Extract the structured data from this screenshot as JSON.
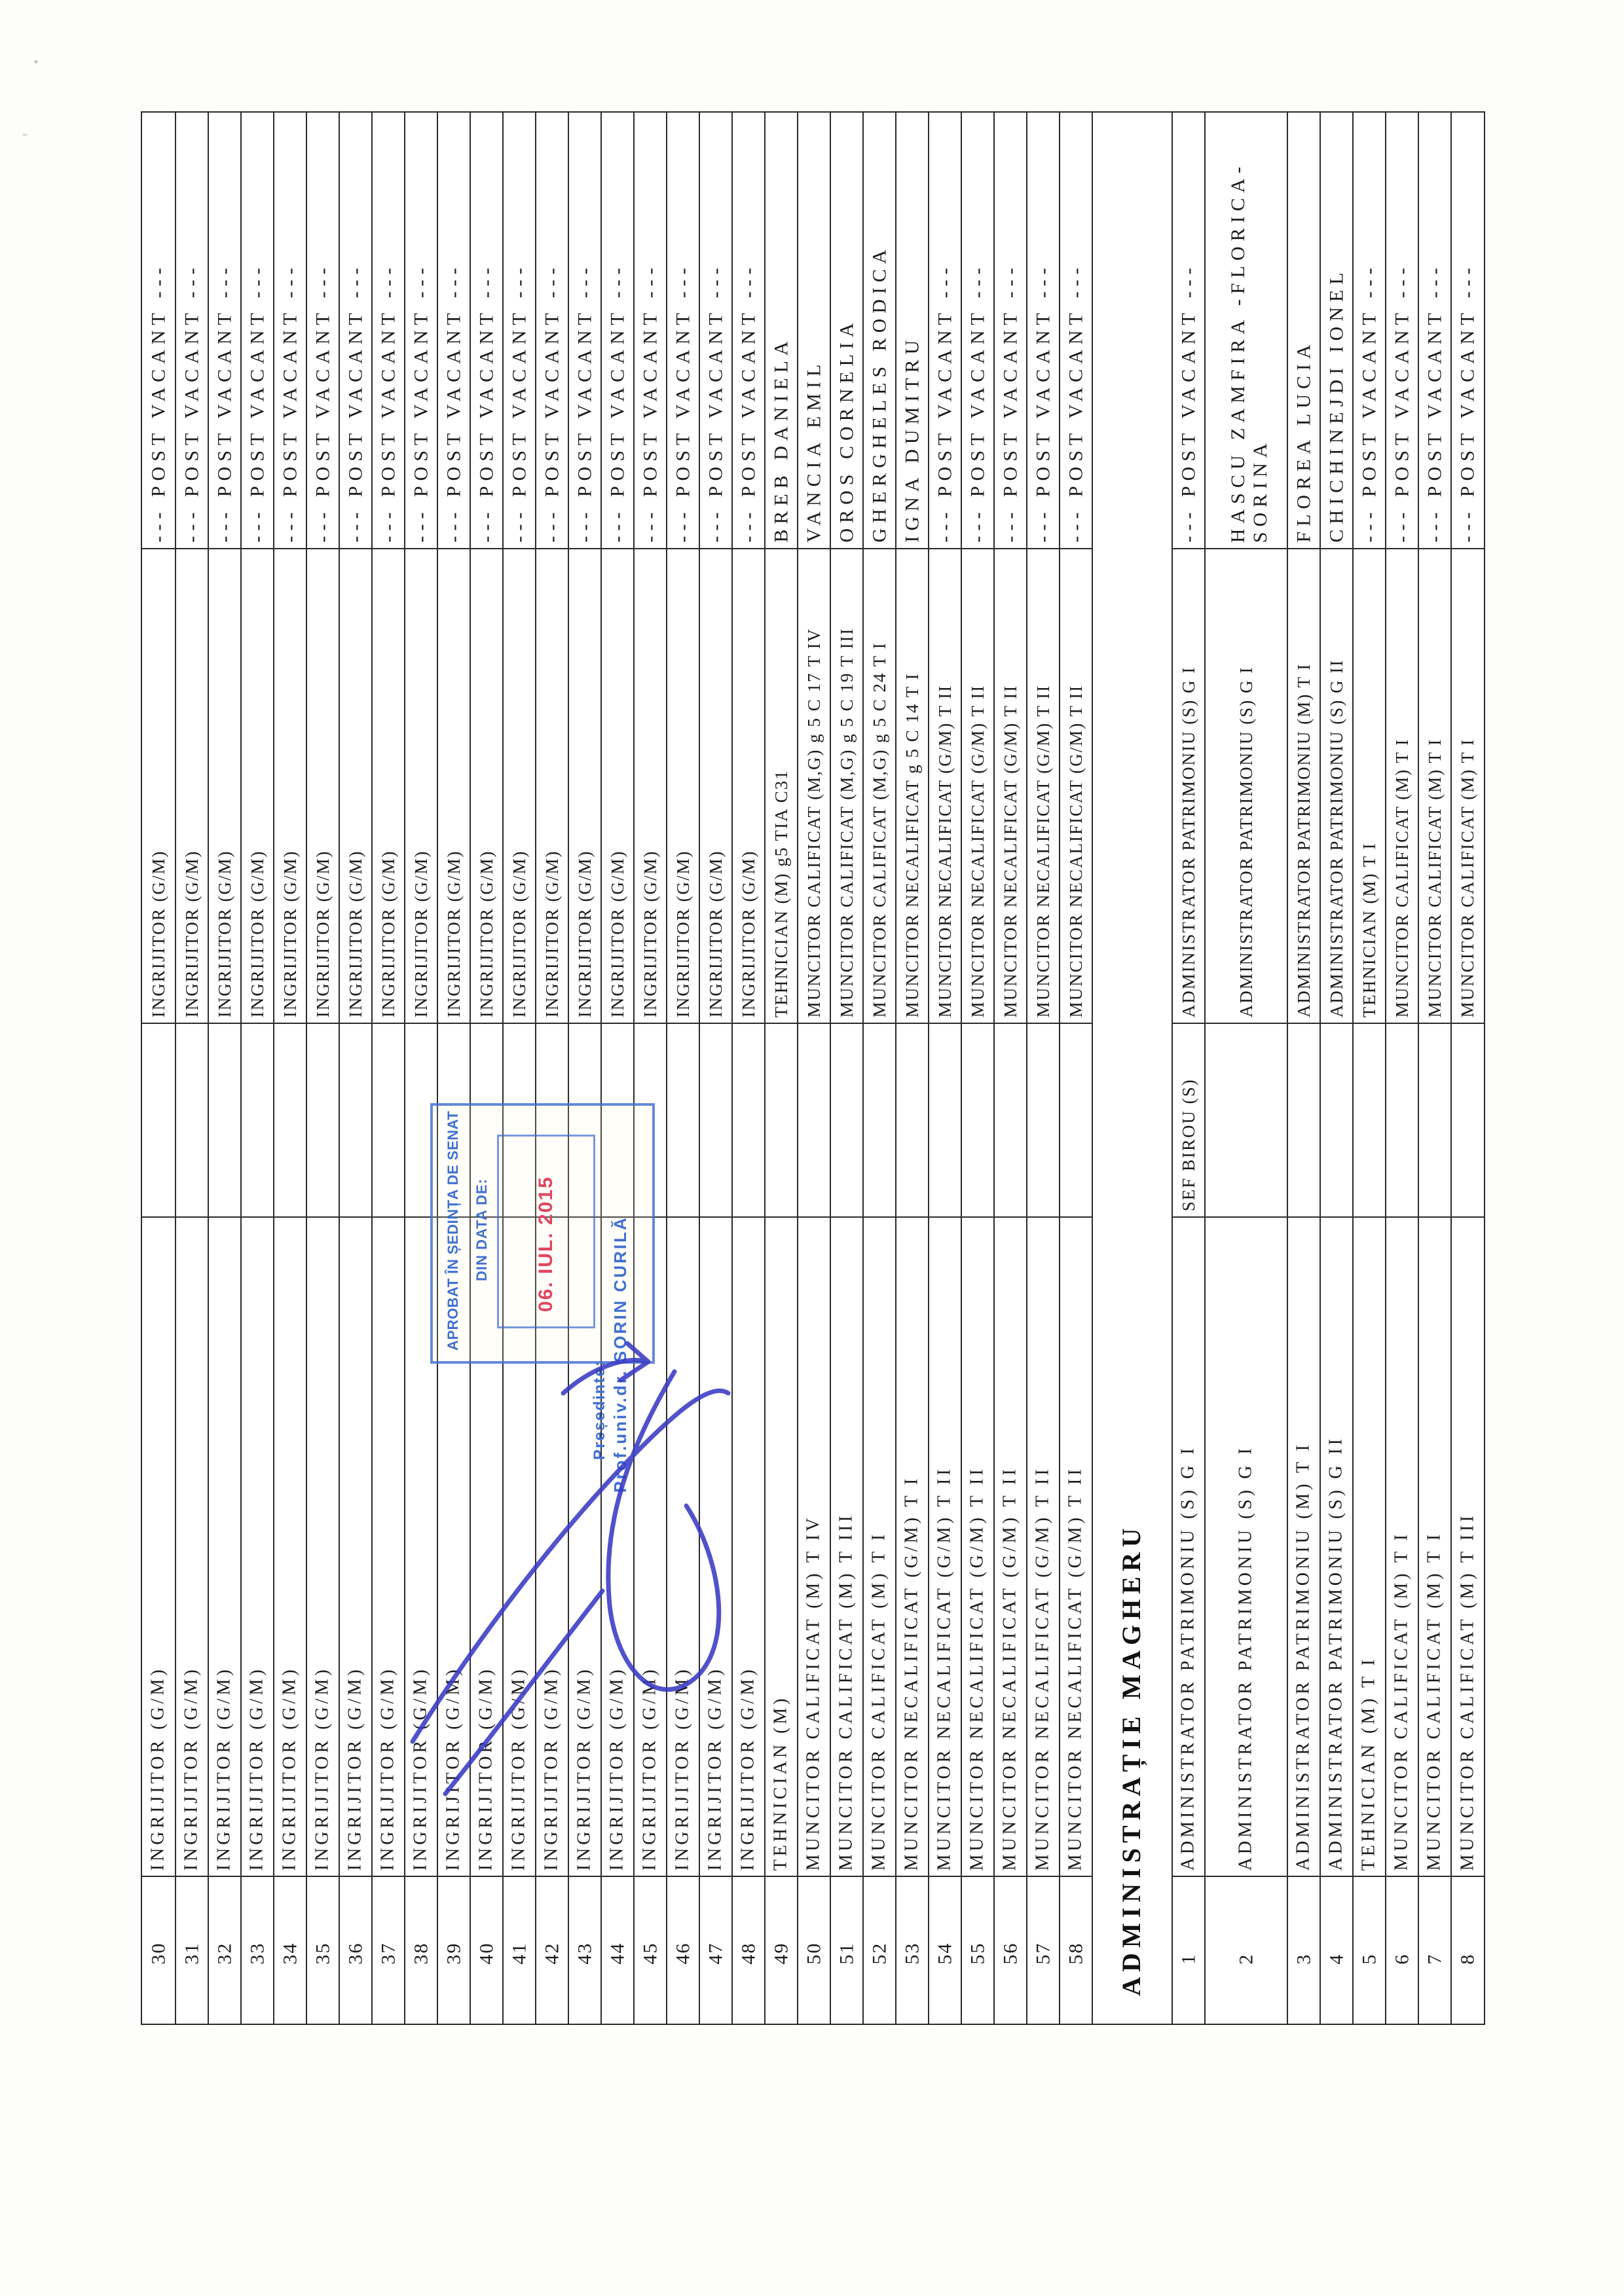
{
  "stamp": {
    "line1": "APROBAT ÎN ȘEDINȚA DE SENAT",
    "line2": "DIN DATA DE:",
    "date": "06. IUL. 2015",
    "president_label": "Președinte:",
    "president_name": "Prof.univ.dr. SORIN CURILĂ",
    "stamp_blue": "#3f6fd2",
    "date_red": "#e0455e",
    "ink_blue": "#3a3ac4"
  },
  "table": {
    "column_roles": [
      "row-number",
      "position",
      "management-position",
      "position-detail",
      "holder-name"
    ],
    "vacant_text": "--- POST VACANT ---",
    "section_label": "ADMINISTRAȚIE MAGHERU",
    "strips": [
      {
        "kind": "row",
        "num": "30",
        "pos1": "INGRIJITOR (G/M)",
        "lead": "",
        "pos2": "INGRIJITOR (G/M)",
        "name": "--- POST VACANT ---"
      },
      {
        "kind": "row",
        "num": "31",
        "pos1": "INGRIJITOR (G/M)",
        "lead": "",
        "pos2": "INGRIJITOR (G/M)",
        "name": "--- POST VACANT ---"
      },
      {
        "kind": "row",
        "num": "32",
        "pos1": "INGRIJITOR (G/M)",
        "lead": "",
        "pos2": "INGRIJITOR (G/M)",
        "name": "--- POST VACANT ---"
      },
      {
        "kind": "row",
        "num": "33",
        "pos1": "INGRIJITOR (G/M)",
        "lead": "",
        "pos2": "INGRIJITOR (G/M)",
        "name": "--- POST VACANT ---"
      },
      {
        "kind": "row",
        "num": "34",
        "pos1": "INGRIJITOR (G/M)",
        "lead": "",
        "pos2": "INGRIJITOR (G/M)",
        "name": "--- POST VACANT ---"
      },
      {
        "kind": "row",
        "num": "35",
        "pos1": "INGRIJITOR (G/M)",
        "lead": "",
        "pos2": "INGRIJITOR (G/M)",
        "name": "--- POST VACANT ---"
      },
      {
        "kind": "row",
        "num": "36",
        "pos1": "INGRIJITOR (G/M)",
        "lead": "",
        "pos2": "INGRIJITOR (G/M)",
        "name": "--- POST VACANT ---"
      },
      {
        "kind": "row",
        "num": "37",
        "pos1": "INGRIJITOR (G/M)",
        "lead": "",
        "pos2": "INGRIJITOR (G/M)",
        "name": "--- POST VACANT ---"
      },
      {
        "kind": "row",
        "num": "38",
        "pos1": "INGRIJITOR (G/M)",
        "lead": "",
        "pos2": "INGRIJITOR (G/M)",
        "name": "--- POST VACANT ---"
      },
      {
        "kind": "row",
        "num": "39",
        "pos1": "INGRIJITOR (G/M)",
        "lead": "",
        "pos2": "INGRIJITOR (G/M)",
        "name": "--- POST VACANT ---"
      },
      {
        "kind": "row",
        "num": "40",
        "pos1": "INGRIJITOR (G/M)",
        "lead": "",
        "pos2": "INGRIJITOR (G/M)",
        "name": "--- POST VACANT ---"
      },
      {
        "kind": "row",
        "num": "41",
        "pos1": "INGRIJITOR (G/M)",
        "lead": "",
        "pos2": "INGRIJITOR (G/M)",
        "name": "--- POST VACANT ---"
      },
      {
        "kind": "row",
        "num": "42",
        "pos1": "INGRIJITOR (G/M)",
        "lead": "",
        "pos2": "INGRIJITOR (G/M)",
        "name": "--- POST VACANT ---"
      },
      {
        "kind": "row",
        "num": "43",
        "pos1": "INGRIJITOR (G/M)",
        "lead": "",
        "pos2": "INGRIJITOR (G/M)",
        "name": "--- POST VACANT ---"
      },
      {
        "kind": "row",
        "num": "44",
        "pos1": "INGRIJITOR (G/M)",
        "lead": "",
        "pos2": "INGRIJITOR (G/M)",
        "name": "--- POST VACANT ---"
      },
      {
        "kind": "row",
        "num": "45",
        "pos1": "INGRIJITOR (G/M)",
        "lead": "",
        "pos2": "INGRIJITOR (G/M)",
        "name": "--- POST VACANT ---"
      },
      {
        "kind": "row",
        "num": "46",
        "pos1": "INGRIJITOR (G/M)",
        "lead": "",
        "pos2": "INGRIJITOR (G/M)",
        "name": "--- POST VACANT ---"
      },
      {
        "kind": "row",
        "num": "47",
        "pos1": "INGRIJITOR (G/M)",
        "lead": "",
        "pos2": "INGRIJITOR (G/M)",
        "name": "--- POST VACANT ---"
      },
      {
        "kind": "row",
        "num": "48",
        "pos1": "INGRIJITOR (G/M)",
        "lead": "",
        "pos2": "INGRIJITOR (G/M)",
        "name": "--- POST VACANT ---"
      },
      {
        "kind": "row",
        "num": "49",
        "pos1": "TEHNICIAN (M)",
        "lead": "",
        "pos2": "TEHNICIAN (M) g5 TIA C31",
        "name": "BREB DANIELA"
      },
      {
        "kind": "row",
        "num": "50",
        "pos1": "MUNCITOR CALIFICAT (M) T IV",
        "lead": "",
        "pos2": "MUNCITOR CALIFICAT (M,G) g 5 C 17 T IV",
        "name": "VANCIA EMIL"
      },
      {
        "kind": "row",
        "num": "51",
        "pos1": "MUNCITOR CALIFICAT (M) T III",
        "lead": "",
        "pos2": "MUNCITOR CALIFICAT (M,G) g 5 C 19 T III",
        "name": "OROS CORNELIA"
      },
      {
        "kind": "row",
        "num": "52",
        "pos1": "MUNCITOR CALIFICAT (M) T I",
        "lead": "",
        "pos2": "MUNCITOR CALIFICAT (M,G) g 5 C 24 T I",
        "name": "GHERGHELES RODICA"
      },
      {
        "kind": "row",
        "num": "53",
        "pos1": "MUNCITOR NECALIFICAT (G/M) T I",
        "lead": "",
        "pos2": "MUNCITOR NECALIFICAT g 5 C 14 T I",
        "name": "IGNA DUMITRU"
      },
      {
        "kind": "row",
        "num": "54",
        "pos1": "MUNCITOR NECALIFICAT (G/M) T II",
        "lead": "",
        "pos2": "MUNCITOR NECALIFICAT (G/M) T II",
        "name": "--- POST VACANT ---"
      },
      {
        "kind": "row",
        "num": "55",
        "pos1": "MUNCITOR NECALIFICAT (G/M) T II",
        "lead": "",
        "pos2": "MUNCITOR NECALIFICAT (G/M) T II",
        "name": "--- POST VACANT ---"
      },
      {
        "kind": "row",
        "num": "56",
        "pos1": "MUNCITOR NECALIFICAT (G/M) T II",
        "lead": "",
        "pos2": "MUNCITOR NECALIFICAT (G/M) T II",
        "name": "--- POST VACANT ---"
      },
      {
        "kind": "row",
        "num": "57",
        "pos1": "MUNCITOR NECALIFICAT (G/M) T II",
        "lead": "",
        "pos2": "MUNCITOR NECALIFICAT (G/M) T II",
        "name": "--- POST VACANT ---"
      },
      {
        "kind": "row",
        "num": "58",
        "pos1": "MUNCITOR NECALIFICAT (G/M) T II",
        "lead": "",
        "pos2": "MUNCITOR NECALIFICAT (G/M) T II",
        "name": "--- POST VACANT ---"
      },
      {
        "kind": "section",
        "label": "ADMINISTRAȚIE MAGHERU"
      },
      {
        "kind": "row",
        "num": "1",
        "pos1": "ADMINISTRATOR PATRIMONIU (S) G I",
        "lead": "SEF BIROU (S)",
        "pos2": "ADMINISTRATOR PATRIMONIU (S) G I",
        "name": "--- POST VACANT ---"
      },
      {
        "kind": "row",
        "num": "2",
        "wide": true,
        "pos1": "ADMINISTRATOR PATRIMONIU (S) G I",
        "lead": "",
        "pos2": "ADMINISTRATOR PATRIMONIU (S) G I",
        "name": [
          "HASCU ZAMFIRA -FLORICA-",
          "SORINA"
        ]
      },
      {
        "kind": "row",
        "num": "3",
        "pos1": "ADMINISTRATOR PATRIMONIU (M) T I",
        "lead": "",
        "pos2": "ADMINISTRATOR PATRIMONIU (M) T I",
        "name": "FLOREA LUCIA"
      },
      {
        "kind": "row",
        "num": "4",
        "pos1": "ADMINISTRATOR PATRIMONIU (S) G II",
        "lead": "",
        "pos2": "ADMINISTRATOR PATRIMONIU (S) G II",
        "name": "CHICHINEJDI IONEL"
      },
      {
        "kind": "row",
        "num": "5",
        "pos1": "TEHNICIAN (M) T I",
        "lead": "",
        "pos2": "TEHNICIAN (M) T I",
        "name": "--- POST VACANT ---"
      },
      {
        "kind": "row",
        "num": "6",
        "pos1": "MUNCITOR CALIFICAT (M) T I",
        "lead": "",
        "pos2": "MUNCITOR CALIFICAT (M) T I",
        "name": "--- POST VACANT ---"
      },
      {
        "kind": "row",
        "num": "7",
        "pos1": "MUNCITOR CALIFICAT (M) T I",
        "lead": "",
        "pos2": "MUNCITOR CALIFICAT (M) T I",
        "name": "--- POST VACANT ---"
      },
      {
        "kind": "row",
        "num": "8",
        "pos1": "MUNCITOR CALIFICAT (M) T III",
        "lead": "",
        "pos2": "MUNCITOR CALIFICAT (M) T I",
        "name": "--- POST VACANT ---"
      }
    ]
  }
}
